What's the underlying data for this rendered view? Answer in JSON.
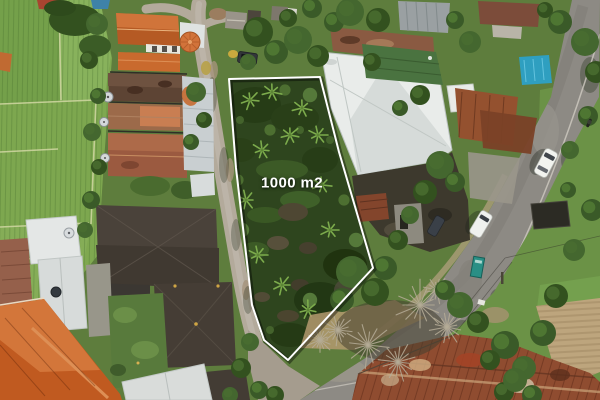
{
  "annotation": {
    "area_label": "1000 m2",
    "outline_color": "#ffffff",
    "polygon_points": "229,79 320,77 339,152 373,268 288,360 264,340 252,305 236,168",
    "label": {
      "x": 292,
      "y": 183
    }
  },
  "palette": {
    "rice_field_green": "#7fa850",
    "plot_vegetation_green": "#2e451e",
    "asphalt_gray": "#8d8a84",
    "lane_gravel": "#b3aa9b",
    "warehouse_roof_white": "#e9ecea",
    "roof_tile_orange": "#c4632a",
    "roof_rust_red": "#8f4c30",
    "roof_dark_charcoal": "#473f37",
    "tarp_blue": "#2f9fc0",
    "roadside_sign_teal": "#2a8f85"
  }
}
